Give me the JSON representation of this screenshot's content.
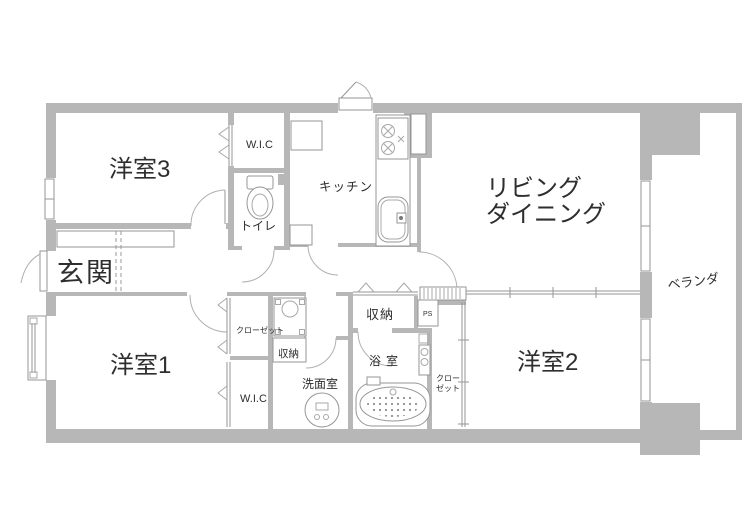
{
  "floorplan": {
    "type": "apartment-floorplan",
    "rooms": {
      "western_room_3": "洋室3",
      "western_room_1": "洋室1",
      "western_room_2": "洋室2",
      "living_dining_line1": "リビング",
      "living_dining_line2": "ダイニング",
      "entrance": "玄関",
      "kitchen": "キッチン",
      "toilet": "トイレ",
      "wic_upper": "W.I.C",
      "wic_lower": "W.I.C",
      "storage_hall": "収納",
      "storage_washroom": "収納",
      "washroom": "洗面室",
      "bathroom": "浴室",
      "closet_room1": "クローゼット",
      "closet_room2_line1": "クロー",
      "closet_room2_line2": "ゼット",
      "pipe_space": "PS",
      "veranda": "ベランダ"
    },
    "colors": {
      "wall": "#b7b7b7",
      "line": "#969696",
      "text": "#2e2e2e",
      "background": "#ffffff"
    }
  }
}
